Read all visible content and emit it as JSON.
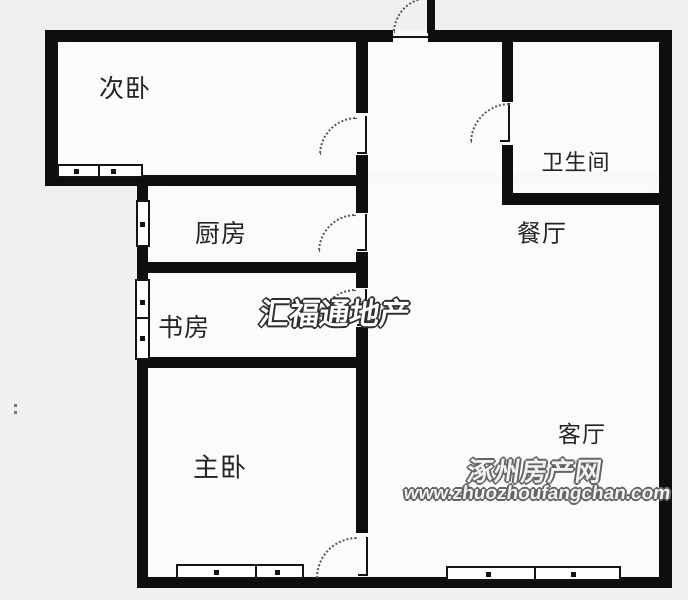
{
  "floorplan": {
    "rooms": [
      {
        "name": "secondary-bedroom",
        "label": "次卧"
      },
      {
        "name": "kitchen",
        "label": "厨房"
      },
      {
        "name": "study",
        "label": "书房"
      },
      {
        "name": "master-bedroom",
        "label": "主卧"
      },
      {
        "name": "bathroom",
        "label": "卫生间"
      },
      {
        "name": "dining-room",
        "label": "餐厅"
      },
      {
        "name": "living-room",
        "label": "客厅"
      }
    ]
  },
  "watermarks": {
    "agency": "汇福通地产",
    "site_name": "涿州房产网",
    "site_url": "www.zhuozhoufangchan.com"
  },
  "colors": {
    "wall": "#0e0e0e",
    "background": "#f1f0ee",
    "room_fill": "#fbfbf9",
    "arc": "#585858",
    "watermark_fill": "#ffffff",
    "watermark_outline": "#2e2e2e",
    "site_watermark_fill": "#f2f2f2",
    "site_watermark_outline": "#646464"
  }
}
